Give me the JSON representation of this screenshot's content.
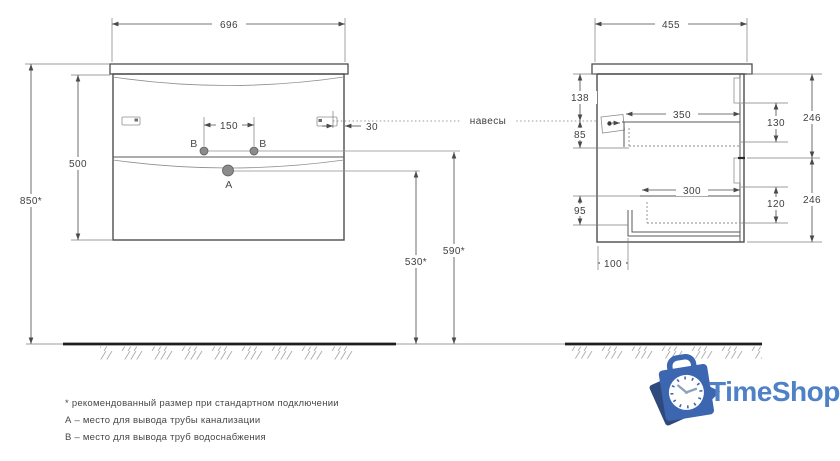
{
  "front_view": {
    "width": "696",
    "total_height": "850*",
    "carcass_height": "500",
    "supply_spacing": "150",
    "handle_offset": "30",
    "drain_height": "530*",
    "supply_height": "590*",
    "point_a": "А",
    "point_b": "В"
  },
  "side_view": {
    "depth": "455",
    "hanger_from_top": "138",
    "hanger_to_drawer": "85",
    "drawer_top_depth": "350",
    "drawer_top_height": "130",
    "facade_top_height": "246",
    "drawer_bottom_depth": "300",
    "drawer_bottom_height": "120",
    "facade_bottom_height": "246",
    "bottom_clearance": "95",
    "back_recess": "100",
    "hangers_label": "навесы"
  },
  "footnotes": {
    "recommended": "* рекомендованный размер при стандартном подключении",
    "point_a": "А – место для вывода трубы канализации",
    "point_b": "В – место для вывода труб водоснабжения"
  },
  "logo": {
    "brand": "TimeShop"
  },
  "colors": {
    "brand_text": "#4f81c7",
    "bag_blue": "#3d66b1",
    "bag_shadow": "#2e4a7d"
  }
}
